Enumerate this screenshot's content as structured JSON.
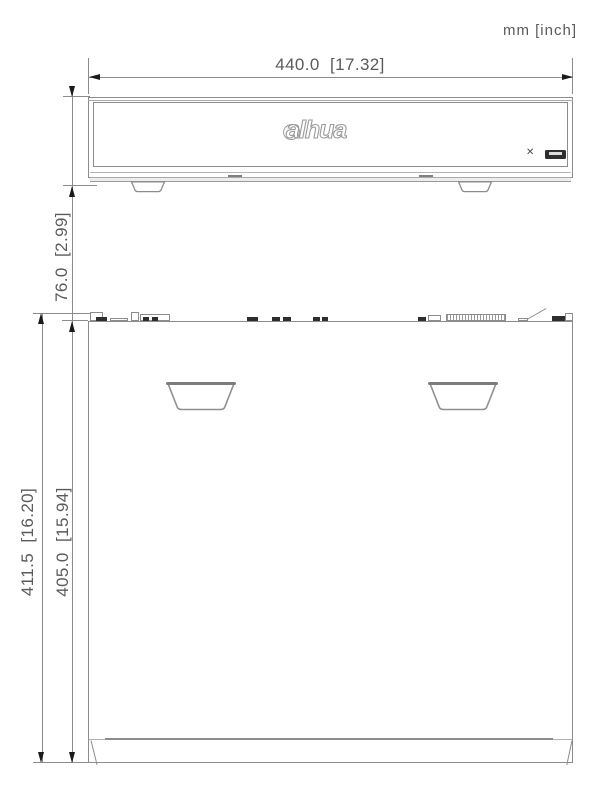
{
  "units": "mm [inch]",
  "dimensions": {
    "width": "440.0  [17.32]",
    "height": "76.0  [2.99]",
    "depth_total": "411.5  [16.20]",
    "depth_body": "405.0  [15.94]"
  },
  "logo": "alhua",
  "front_panel": {
    "marking_glyph": "✕"
  },
  "colors": {
    "line": "#8c8c8c",
    "dark": "#2e2e2e",
    "text": "#5a5a5a",
    "arrow": "#1a1a1a",
    "background": "#ffffff"
  },
  "top_view": {
    "connectors": [
      {
        "x": 90,
        "w": 13,
        "h": 9,
        "variant": "outline"
      },
      {
        "x": 96,
        "w": 11,
        "h": 4,
        "variant": "dark"
      },
      {
        "x": 110,
        "w": 18,
        "h": 3,
        "variant": "outline"
      },
      {
        "x": 131,
        "w": 8,
        "h": 9,
        "variant": "outline"
      },
      {
        "x": 140,
        "w": 30,
        "h": 7,
        "variant": "outline"
      },
      {
        "x": 143,
        "w": 6,
        "h": 4,
        "variant": "dark"
      },
      {
        "x": 152,
        "w": 6,
        "h": 4,
        "variant": "dark"
      },
      {
        "x": 247,
        "w": 11,
        "h": 4,
        "variant": "dark"
      },
      {
        "x": 272,
        "w": 8,
        "h": 4,
        "variant": "dark"
      },
      {
        "x": 283,
        "w": 8,
        "h": 4,
        "variant": "dark"
      },
      {
        "x": 313,
        "w": 7,
        "h": 4,
        "variant": "dark"
      },
      {
        "x": 322,
        "w": 6,
        "h": 4,
        "variant": "dark"
      },
      {
        "x": 418,
        "w": 8,
        "h": 4,
        "variant": "dark"
      },
      {
        "x": 428,
        "w": 13,
        "h": 6,
        "variant": "outline"
      },
      {
        "x": 446,
        "w": 60,
        "h": 7,
        "variant": "striped"
      },
      {
        "x": 518,
        "w": 10,
        "h": 3,
        "variant": "outline"
      },
      {
        "x": 552,
        "w": 13,
        "h": 5,
        "variant": "dark"
      },
      {
        "x": 565,
        "w": 8,
        "h": 8,
        "variant": "outline"
      }
    ]
  }
}
